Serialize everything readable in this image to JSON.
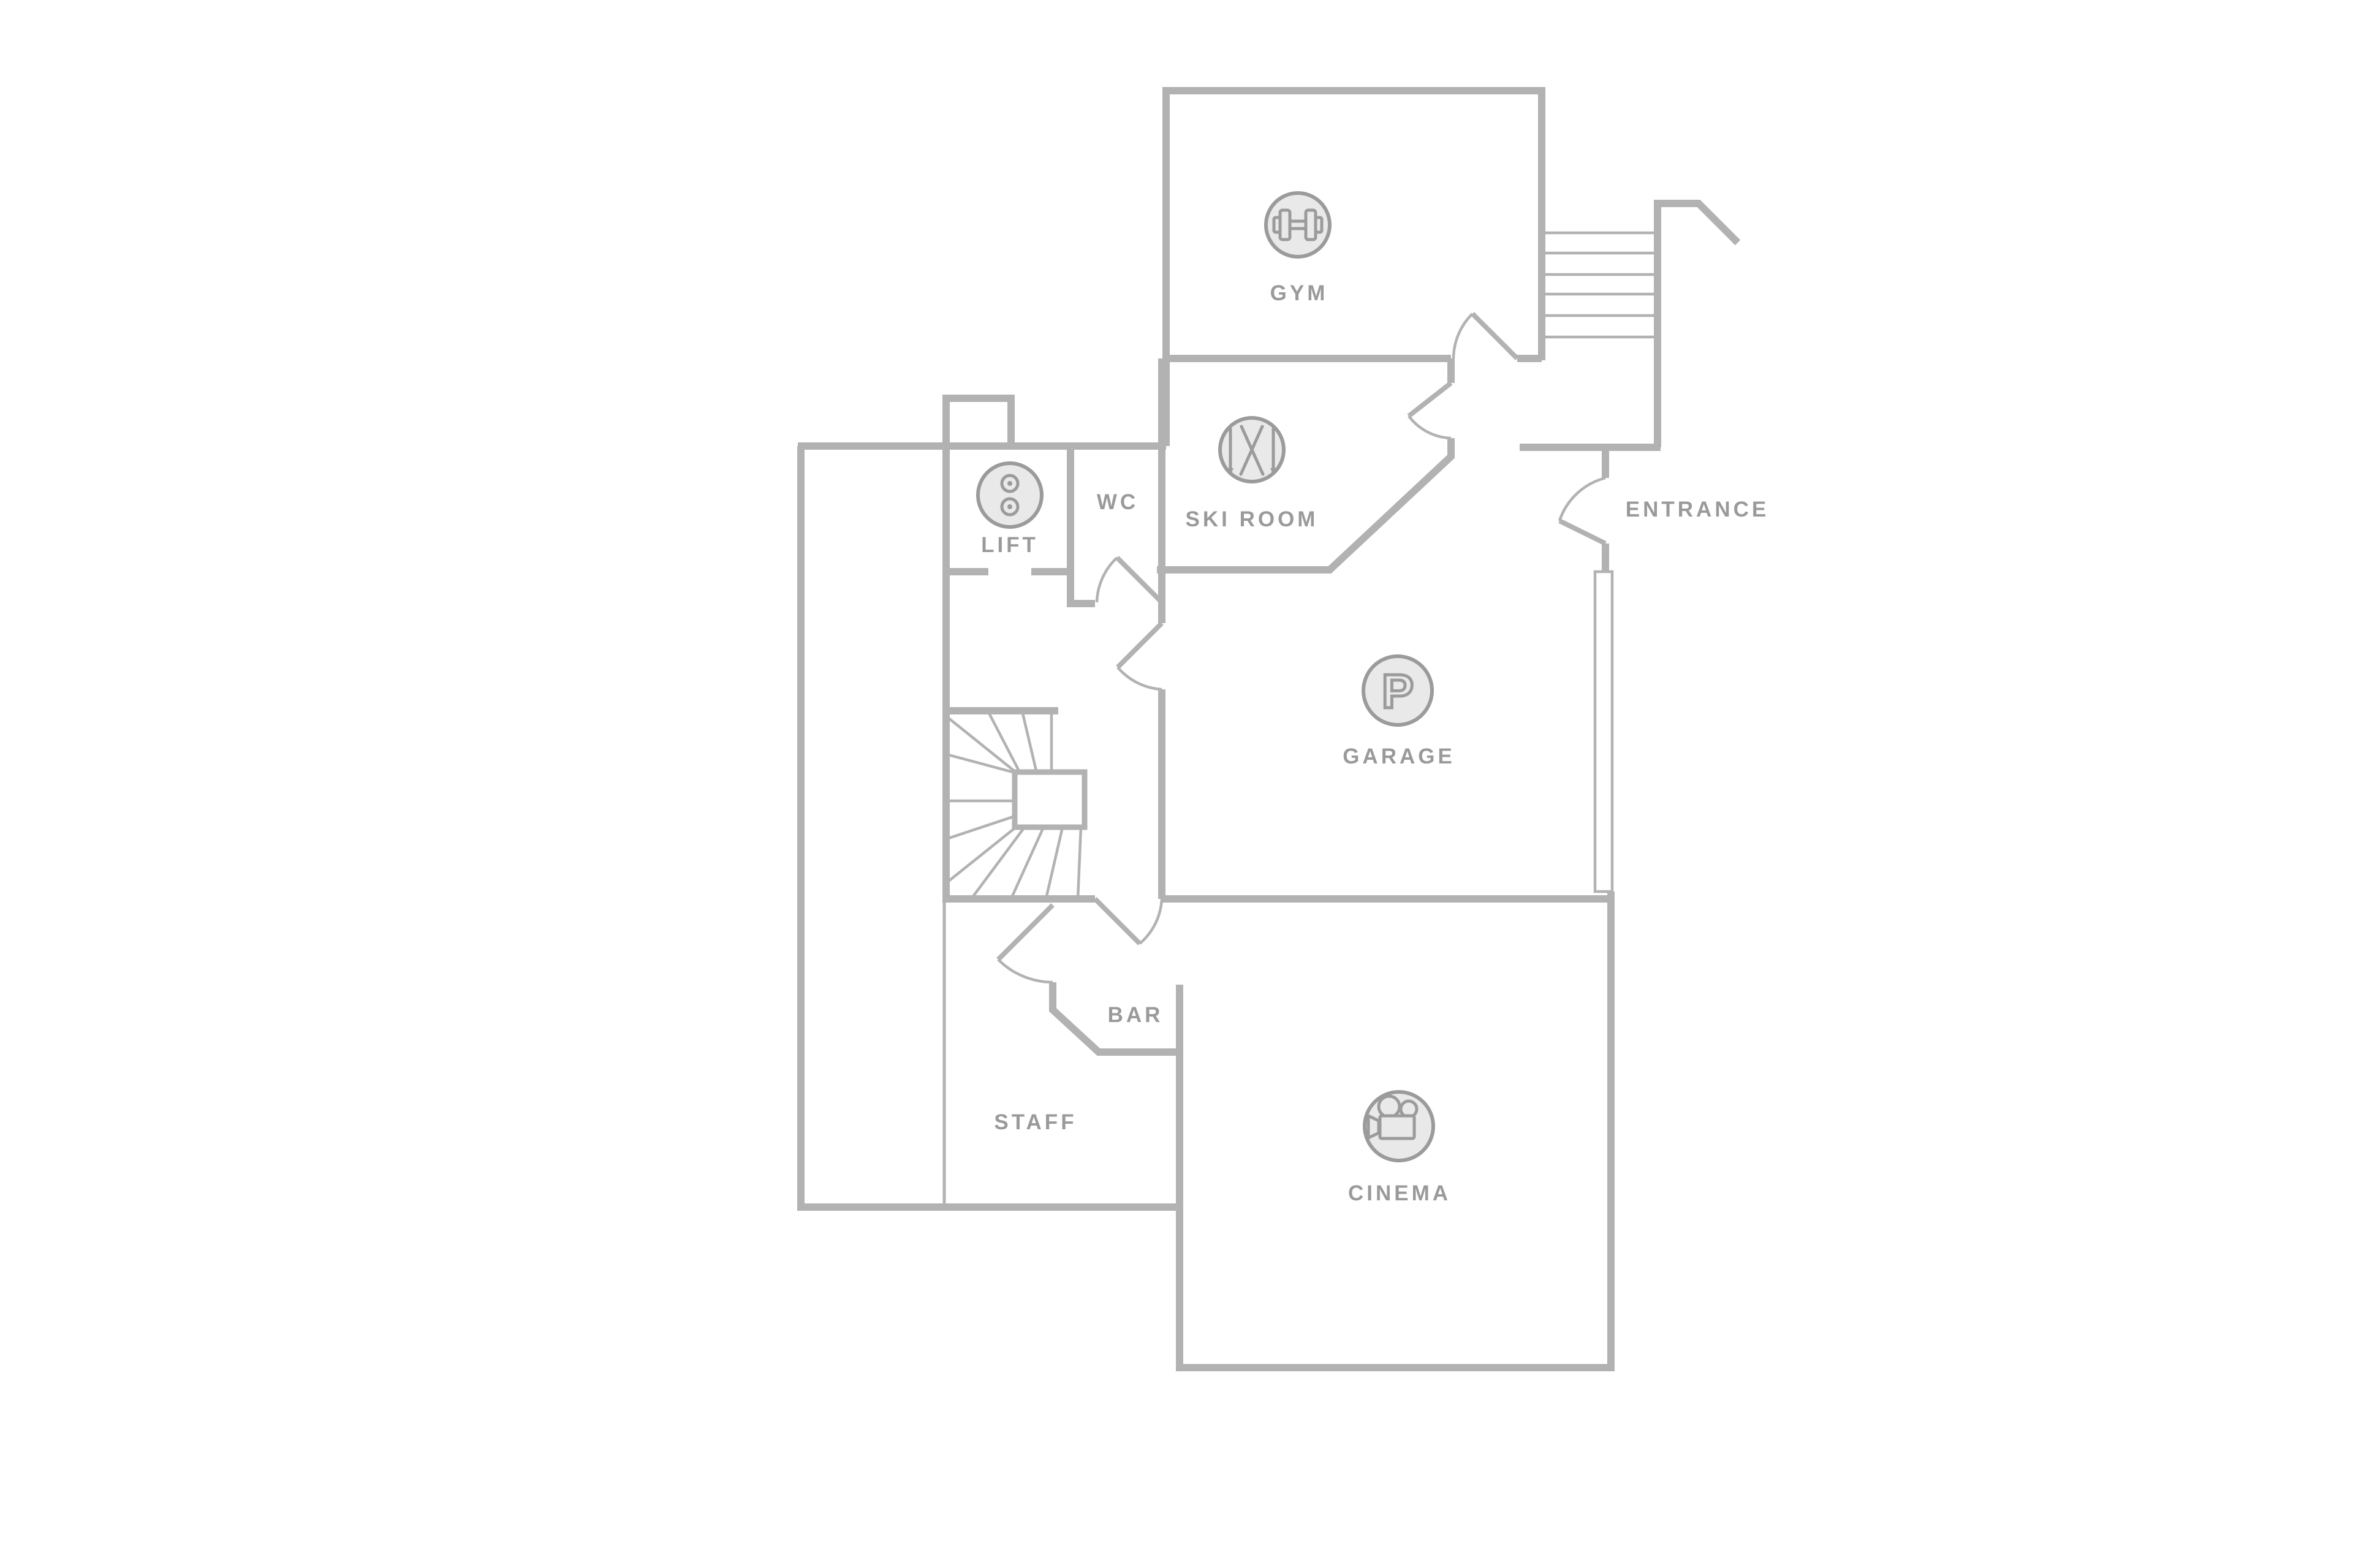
{
  "colors": {
    "background": "#ffffff",
    "wall": "#b2b2b2",
    "label": "#9a9a9a",
    "icon_fill": "#e9e9e9",
    "icon_stroke": "#9b9b9b"
  },
  "rooms": {
    "gym": {
      "label": "GYM",
      "icon": "dumbbell-icon"
    },
    "ski_room": {
      "label": "SKI ROOM",
      "icon": "crossed-skis-icon"
    },
    "lift": {
      "label": "LIFT",
      "icon": "elevator-buttons-icon"
    },
    "wc": {
      "label": "WC"
    },
    "garage": {
      "label": "GARAGE",
      "icon": "parking-p-icon",
      "p_glyph": "P"
    },
    "entrance": {
      "label": "ENTRANCE"
    },
    "bar": {
      "label": "BAR"
    },
    "staff": {
      "label": "STAFF"
    },
    "cinema": {
      "label": "CINEMA",
      "icon": "movie-camera-icon"
    }
  },
  "features": [
    "exterior-entrance-stairs",
    "winder-staircase",
    "door-swing-arcs",
    "garage-window-strip",
    "lift-shaft-bump"
  ]
}
